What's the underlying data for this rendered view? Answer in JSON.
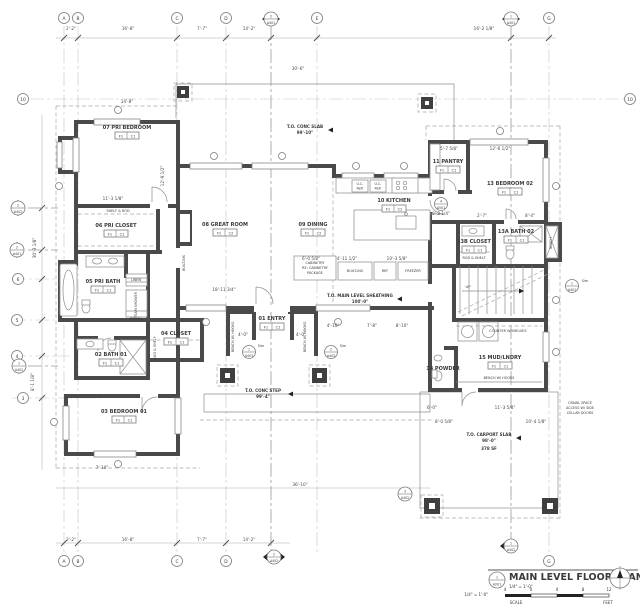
{
  "drawing_title": "MAIN LEVEL FLOOR PLAN",
  "title_block": {
    "view_number": "1",
    "sheet_ref": "A201",
    "scale": "1/4\" = 1'-0\"",
    "scale_caption": "1/4\" = 1'-0\"",
    "scale_label": "SCALE",
    "feet_label": "FEET",
    "ticks": [
      "4",
      "0",
      "4",
      "8",
      "12"
    ]
  },
  "grid": {
    "a": "A",
    "b": "B",
    "c": "C",
    "d": "D",
    "e": "E",
    "g": "G",
    "n10": "10",
    "n6": "6",
    "n5": "5",
    "n4": "4",
    "n3": "3"
  },
  "markers": {
    "m_top1": {
      "n": "2",
      "s": "A401"
    },
    "m_top2": {
      "n": "1",
      "s": "A401"
    },
    "m_left1": {
      "n": "2",
      "s": "A402"
    },
    "m_left2": {
      "n": "2",
      "s": "A401"
    },
    "m_left3": {
      "n": "1",
      "s": "A402"
    },
    "m_bot1": {
      "n": "2",
      "s": "A402"
    },
    "m_bot2": {
      "n": "1",
      "s": "A402"
    },
    "m_car": {
      "n": "3",
      "s": "A402"
    },
    "d_ent1": {
      "n": "1",
      "s": "A403"
    },
    "d_ent2": {
      "n": "2",
      "s": "A403"
    },
    "d_kit": {
      "n": "4",
      "s": "A501"
    },
    "d_stair": {
      "n": "1",
      "s": "A401"
    },
    "sim": "Sim"
  },
  "rooms": [
    {
      "label": "07  PRI BEDROOM",
      "f": "F1",
      "c": "C1"
    },
    {
      "label": "06  PRI CLOSET",
      "f": "F1",
      "c": "C1"
    },
    {
      "label": "05  PRI BATH",
      "f": "F1",
      "c": "C1"
    },
    {
      "label": "04  CLOSET",
      "f": "F1",
      "c": "C1"
    },
    {
      "label": "02  BATH 01",
      "f": "F1",
      "c": "C1"
    },
    {
      "label": "03  BEDROOM 01",
      "f": "F1",
      "c": "C1"
    },
    {
      "label": "08  GREAT ROOM",
      "f": "F1",
      "c": "C2"
    },
    {
      "label": "09  DINING",
      "f": "F1",
      "c": "C2"
    },
    {
      "label": "10  KITCHEN",
      "f": "F1",
      "c": "C2"
    },
    {
      "label": "11  PANTRY",
      "f": "F1",
      "c": "C1"
    },
    {
      "label": "13  BEDROOM 02",
      "f": "F1",
      "c": "C1"
    },
    {
      "label": "13A  BATH 02",
      "f": "F1",
      "c": "C1"
    },
    {
      "label": "13B  CLOSET",
      "f": "F1",
      "c": "C1"
    },
    {
      "label": "15  MUD/LNDRY",
      "f": "F1",
      "c": "C1"
    },
    {
      "label": "14  POWDER",
      "f": "F1",
      "c": "C1"
    },
    {
      "label": "01  ENTRY",
      "f": "F1",
      "c": "C1"
    }
  ],
  "ann": {
    "shelf_rod": "SHELF & ROD",
    "linen": "LINEN",
    "steam_shower": "STEAM SHOWER",
    "bench1": "BENCH",
    "rod_shelf1": "ROD & SHELF",
    "rod_shelf2": "ROD & SHELF",
    "bench2": "BENCH",
    "bench_hooks1": "BENCH W/ HOOKS",
    "bench_hooks2": "BENCH W/ HOOKS",
    "bench_hooks3": "BENCH W/ HOOKS",
    "counter_shelves": "COUNTER W/SHELVES",
    "cab1": "CABINETRY",
    "cab2": "RE: CABINETRY",
    "cab3": "PACKAGE",
    "builtins1": "BUILT-INS",
    "builtins2": "BUILT-INS",
    "ref": "REF",
    "freezer": "FREEZER",
    "uc1a": "U.C.",
    "uc1b": "Refr",
    "uc2a": "U.C.",
    "uc2b": "Refr",
    "up": "UP",
    "crawl1": "CRAWL SPACE",
    "crawl2": "ACCESS W/ SIDE",
    "crawl3": "CELLAR DOORS"
  },
  "levels": [
    {
      "l": "T.O. CONC SLAB",
      "e": "99'-10\""
    },
    {
      "l": "T.O. MAIN LEVEL SHEATHING",
      "e": "100'-0\""
    },
    {
      "l": "T.O. CONC STEP",
      "e": "99'-4\""
    },
    {
      "l": "T.O. CARPORT SLAB",
      "e": "98'-0\"",
      "x": "378 SF"
    }
  ],
  "dims": [
    {
      "v": "2'-2\""
    },
    {
      "v": "16'-8\""
    },
    {
      "v": "7'-7\""
    },
    {
      "v": "14'-2\""
    },
    {
      "v": "16'-2 1/8\""
    },
    {
      "v": "30'-6\""
    },
    {
      "v": "14'-8\""
    },
    {
      "v": "11'-3 1/8\""
    },
    {
      "v": "18'-11 3/4\""
    },
    {
      "v": "6'-0 5/8\""
    },
    {
      "v": "4'-11 1/2\""
    },
    {
      "v": "10'-3 5/8\""
    },
    {
      "v": "12'-6 1/2\""
    },
    {
      "v": "5'-7 5/8\""
    },
    {
      "v": "2'-7\""
    },
    {
      "v": "8'-4\""
    },
    {
      "v": "4'-10\""
    },
    {
      "v": "7'-8\""
    },
    {
      "v": "8'-10\""
    },
    {
      "v": "6'-0\""
    },
    {
      "v": "11'-3 5/8\""
    },
    {
      "v": "8'-0 5/8\""
    },
    {
      "v": "10'-4 1/8\""
    },
    {
      "v": "7'-10\""
    },
    {
      "v": "36'-10\""
    },
    {
      "v": "2'-2\""
    },
    {
      "v": "16'-8\""
    },
    {
      "v": "7'-7\""
    },
    {
      "v": "14'-2\""
    },
    {
      "v": "30'-3 1/8\""
    },
    {
      "v": "8'-1 1/8\""
    },
    {
      "v": "9'-2 1/4\""
    },
    {
      "v": "12'-9 1/2\""
    },
    {
      "v": "4'-0\""
    },
    {
      "v": "4'-0\""
    }
  ]
}
